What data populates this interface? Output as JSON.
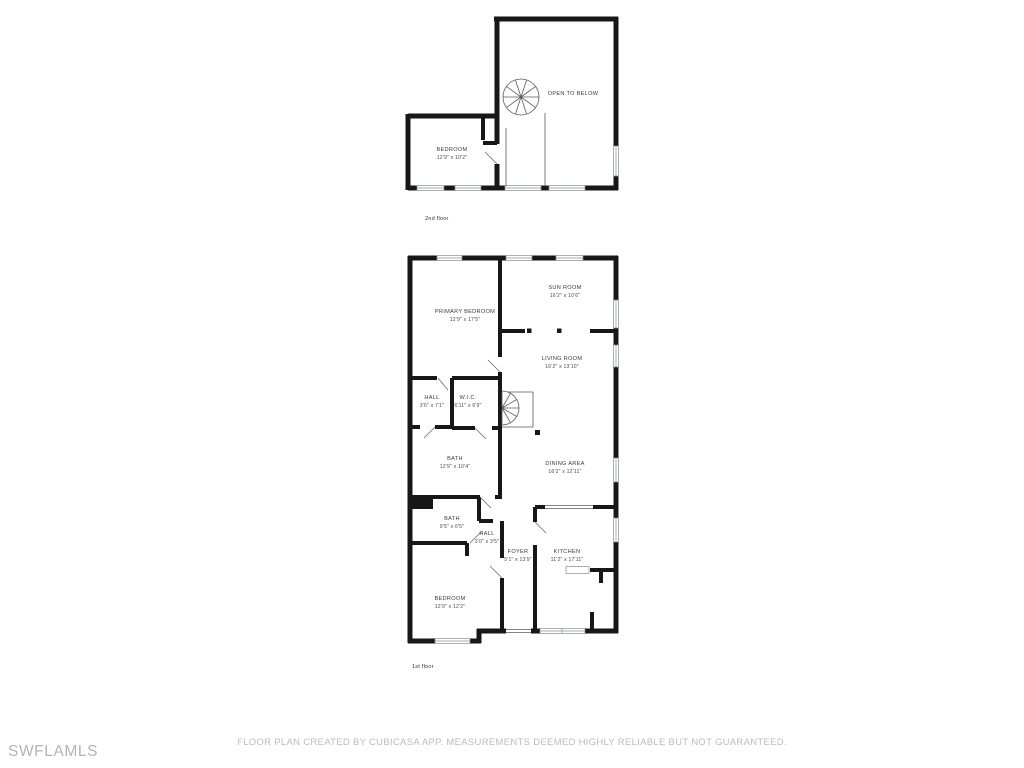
{
  "watermark": "SWFLAMLS",
  "disclaimer": "FLOOR PLAN CREATED BY CUBICASA APP. MEASUREMENTS DEEMED HIGHLY RELIABLE BUT NOT GUARANTEED.",
  "colors": {
    "wall": "#171717",
    "label": "#3a3a3a",
    "muted_text": "#b9bcbf",
    "watermark_text": "#b2b5b8",
    "background": "#ffffff"
  },
  "floors": [
    {
      "label": "2nd floor",
      "rooms": [
        {
          "name": "BEDROOM",
          "dims": "12'9\" x 10'2\""
        },
        {
          "name": "OPEN TO BELOW",
          "dims": ""
        }
      ]
    },
    {
      "label": "1st floor",
      "rooms": [
        {
          "name": "PRIMARY BEDROOM",
          "dims": "12'9\" x 17'5\""
        },
        {
          "name": "SUN ROOM",
          "dims": "16'2\" x 10'6\""
        },
        {
          "name": "LIVING ROOM",
          "dims": "16'2\" x 13'10\""
        },
        {
          "name": "HALL",
          "dims": "3'6\" x 7'1\""
        },
        {
          "name": "W.I.C.",
          "dims": "6'11\" x 6'9\""
        },
        {
          "name": "BATH",
          "dims": "12'9\" x 10'4\""
        },
        {
          "name": "DINING AREA",
          "dims": "16'2\" x 12'11\""
        },
        {
          "name": "BATH",
          "dims": "9'5\" x 6'5\""
        },
        {
          "name": "HALL",
          "dims": "3'0\" x 3'5\""
        },
        {
          "name": "FOYER",
          "dims": "5'1\" x 13'9\""
        },
        {
          "name": "KITCHEN",
          "dims": "11'2\" x 17'11\""
        },
        {
          "name": "BEDROOM",
          "dims": "12'9\" x 12'2\""
        }
      ]
    }
  ]
}
